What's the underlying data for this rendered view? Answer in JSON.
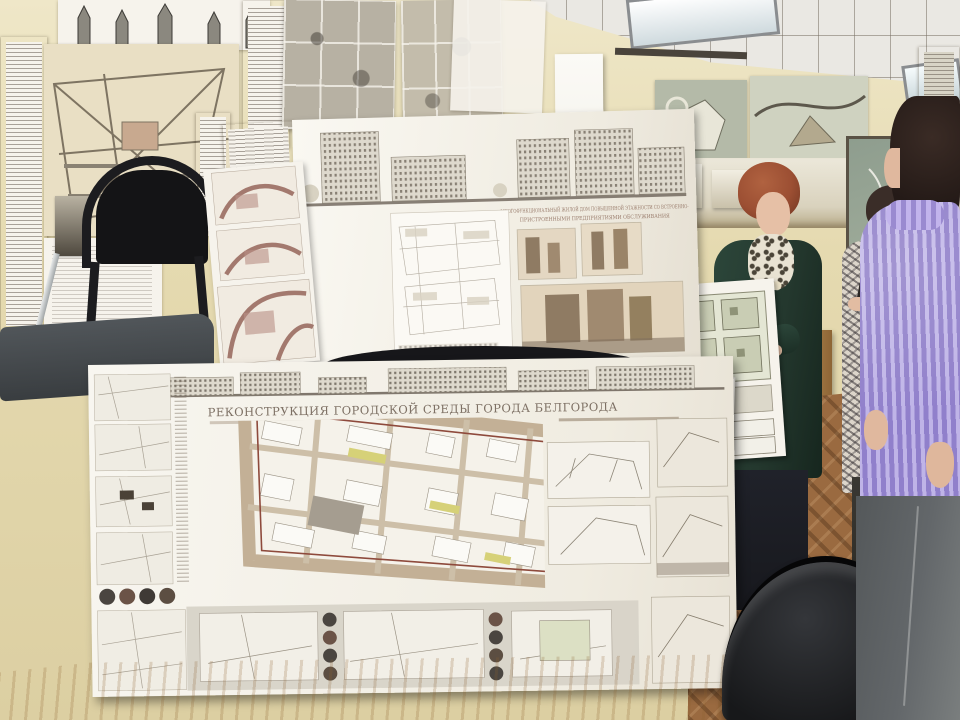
{
  "boards": {
    "upper": {
      "title_line1": "МНОГОФУНКЦИОНАЛЬНЫЙ ЖИЛОЙ ДОМ ПОВЫШЕННОЙ ЭТАЖНОСТИ СО ВСТРОЕННО-",
      "title_line2": "ПРИСТРОЕННЫМИ ПРЕДПРИЯТИЯМИ ОБСЛУЖИВАНИЯ"
    },
    "lower": {
      "title": "РЕКОНСТРУКЦИЯ ГОРОДСКОЙ СРЕДЫ ГОРОДА БЕЛГОРОДА",
      "compass_letter": "С"
    }
  },
  "colors": {
    "wall": "#e5dab0",
    "wall_light": "#efe7c8",
    "ceiling": "#eae8e3",
    "paper": "#f6f3ec",
    "accent_maroon": "#96655a",
    "title_text": "#7d7064",
    "plan_road": "#c3b096",
    "sepia_render": "#c9b49b",
    "chair_black": "#1a1a1d",
    "seat_fabric": "#43474a",
    "table_wood": "#d9b88a",
    "floor_wood": "#9a6a40",
    "cardigan_green": "#24382e",
    "sweater_lavender": "#a393dd",
    "jeans_gray": "#63676a",
    "hair_auburn": "#9c4f33",
    "hair_dark": "#241a17",
    "skin": "#e6c0a6"
  }
}
